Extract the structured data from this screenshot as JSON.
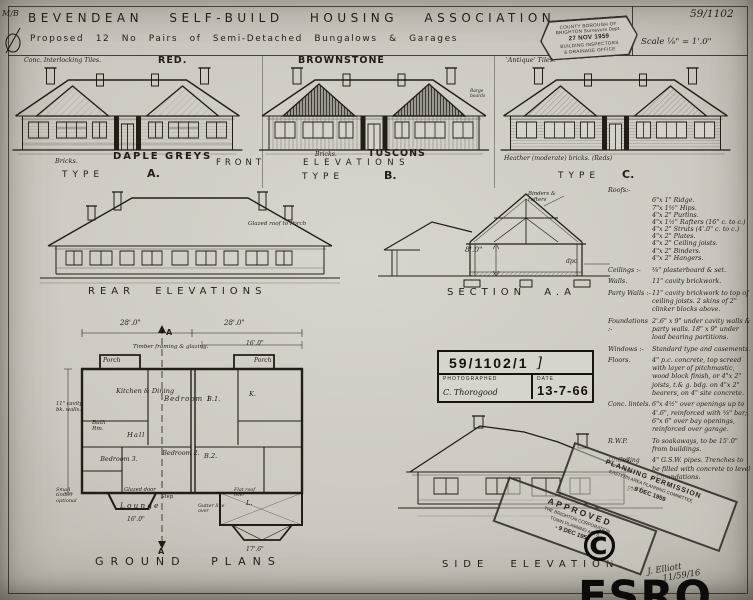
{
  "colors": {
    "paper": "#cdc9c2",
    "ink": "#1e1b15",
    "watermark": "#0c0b09"
  },
  "margin": {
    "mark": "M/B"
  },
  "header": {
    "title": "BEVENDEAN  SELF-BUILD  HOUSING  ASSOCIATION.",
    "drawing_number": "59/1102",
    "subtitle": "Proposed  12 No  Pairs  of  Semi-Detached  Bungalows  &  Garages",
    "scale": "Scale ⅛\" = 1'.0\"",
    "stamp": {
      "line1": "COUNTY BOROUGH OF",
      "line2": "BRIGHTON Surveyors Dept.",
      "date": "27 NOV 1959",
      "line4": "BUILDING INSPECTORS",
      "line5": "& DRAINAGE OFFICE"
    }
  },
  "front_elevations": {
    "row_front": "FRONT",
    "row_elevations": "ELEVATIONS",
    "type_word": "TYPE",
    "type_a": {
      "tile_note": "Conc. Interlocking Tiles.",
      "tile_name": "RED.",
      "bricks_word": "Bricks.",
      "brick_name": "DAPLE GREYS",
      "letter": "A."
    },
    "type_b": {
      "tile_name": "BROWNSTONE",
      "barge_note": "Barge boards",
      "bricks_word": "Bricks.",
      "brick_name": "TUSCONS",
      "letter": "B."
    },
    "type_c": {
      "tile_note": "'Antique' Tiles.",
      "brick_note": "Heather (moderate) bricks. (Reds)",
      "letter": "C."
    }
  },
  "rear_elevation": {
    "label": "REAR  ELEVATIONS",
    "roof_note": "Glazed roof to Porch"
  },
  "section": {
    "label": "SECTION  A.A",
    "height_dim": "8'.0\"",
    "apex_note": "Binders & rafters",
    "dpc_note": "dpc"
  },
  "specs": {
    "roofs_label": "Roofs:-",
    "roofs_items": [
      "6\"x 1\" Ridge.",
      "7\"x 1½\" Hips.",
      "4\"x 2\" Purlins.",
      "4\"x 1½\" Rafters (16\" c. to c.)",
      "4\"x 2\" Struts (4'.0\" c. to c.)",
      "4\"x 2\" Plates.",
      "4\"x 2\" Ceiling joists.",
      "4\"x 2\" Binders.",
      "4\"x 2\" Hangers."
    ],
    "rows": [
      {
        "label": "Ceilings :-",
        "text": "⅜\" plasterboard & set."
      },
      {
        "label": "Walls.",
        "text": "11\" cavity brickwork."
      },
      {
        "label": "Party Walls :-",
        "text": "11\" cavity brickwork to top of ceiling joists. 2 skins of 2\" clinker blocks above."
      },
      {
        "label": "Foundations :-",
        "text": "2'.6\" x 9\" under cavity walls & party walls. 18\" x 9\" under load bearing partitions."
      },
      {
        "label": "Windows :-",
        "text": "Standard type and casements."
      },
      {
        "label": "Floors.",
        "text": "4\" p.c. concrete, top screed with layer of pitchmastic, wood block finish, or 4\"x 2\" joists, t.& g. bdg. on 4\"x 2\" bearers, on 4\" site concrete."
      },
      {
        "label": "Conc. lintels.",
        "text": "6\"x 4½\" over openings up to 4'.6\", reinforced with ⅝\" bar; 6\"x 6\" over bay openings, reinforced over garage."
      },
      {
        "label": "R.W.P.",
        "text": "To soakaways, to be 15'.0\" from buildings."
      },
      {
        "label": "Drains.",
        "text": "4\" G.S.W. pipes. Trenches to be filled with concrete to level of foundations."
      }
    ]
  },
  "photo_box": {
    "reference": "59/1102/1",
    "bracket": "]",
    "photographed_label": "PHOTOGRAPHED",
    "signature": "C. Thorogood",
    "date_label": "DATE",
    "date": "13-7-66"
  },
  "ground_plan": {
    "label": "GROUND  PLANS",
    "dim_left": "28'.0\"",
    "dim_right": "28'.0\"",
    "dim_16": "16'.0\"",
    "framing_note": "Timber framing & glazing.",
    "cavity_note": "11\" cavity bk. walls.",
    "timber_note": "Small timber optional",
    "glazed_door": "Glazed door",
    "step": "Step",
    "flat_roof": "Flat roof over",
    "gutter": "Gutter line over",
    "lounge_dim": "16'.0\"",
    "dim_17": "17'.6\"",
    "section_marker_top": "A",
    "section_marker_bottom": "A",
    "rooms": {
      "porch_left": "Porch",
      "porch_right": "Porch",
      "kitchen_dining": "Kitchen & Dining",
      "bedroom1": "Bedroom 1",
      "b1": "B.1.",
      "k": "K.",
      "bath": "Bath Rm.",
      "hall": "Hall",
      "bedroom3": "Bedroom 3.",
      "bedroom2": "Bedroom 2.",
      "b2": "B.2.",
      "lounge": "Lounge",
      "l": "L."
    }
  },
  "side_elevation": {
    "label": "SIDE  ELEVATION.",
    "ceiling_note": "Ceiling",
    "floor_note": "Floor"
  },
  "stamps": {
    "approved": {
      "line1": "APPROVED",
      "line2": "THE BRIGHTON CORPORATION",
      "line3": "TOWN PLANNING ACTS",
      "date": "- 9 DEC 1959"
    },
    "planning": {
      "line1": "PLANNING PERMISSION",
      "line2": "EASTERN AREA PLANNING COMMITTEE",
      "date": "- 9 DEC 1959"
    }
  },
  "footer": {
    "watermark": "© ESRO",
    "signature": "J. Elliott",
    "signature_ref": "11/59/16"
  }
}
